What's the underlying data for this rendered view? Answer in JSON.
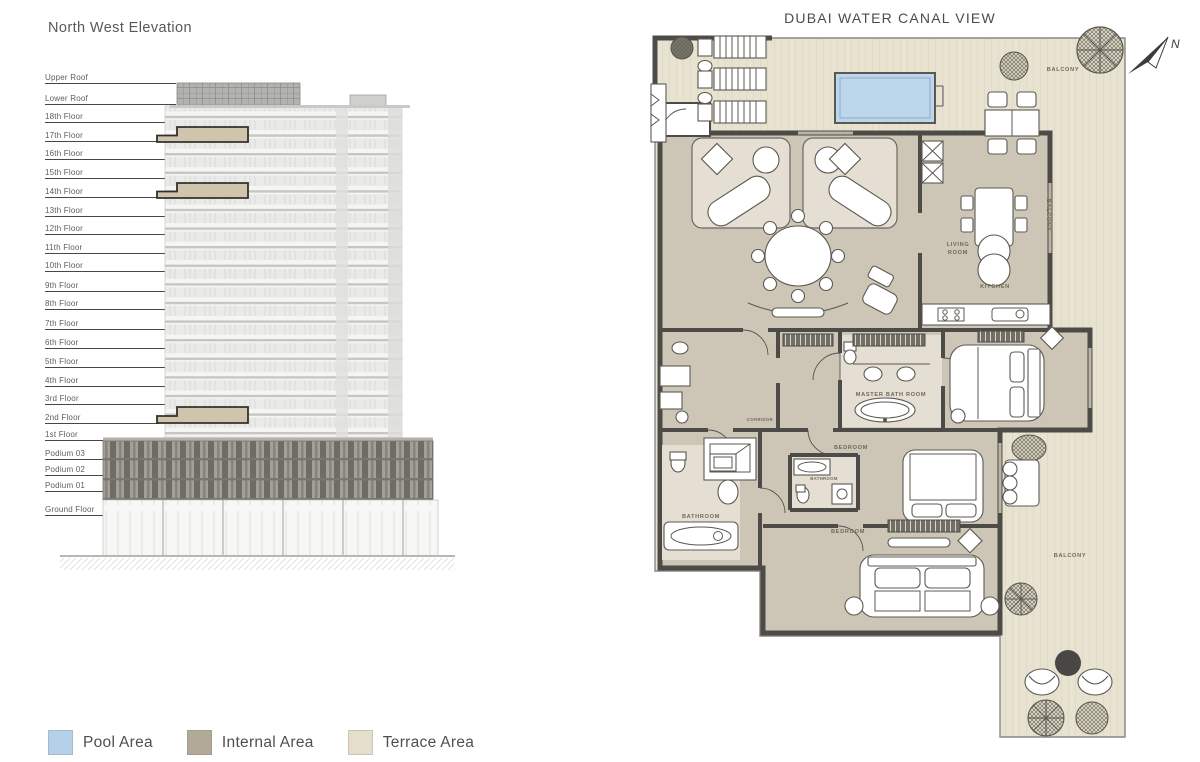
{
  "elevation": {
    "title": "North West Elevation",
    "floors": [
      "Upper Roof",
      "Lower Roof",
      "18th Floor",
      "17th Floor",
      "16th Floor",
      "15th Floor",
      "14th Floor",
      "13th Floor",
      "12th Floor",
      "11th Floor",
      "10th Floor",
      "9th Floor",
      "8th Floor",
      "7th Floor",
      "6th Floor",
      "5th Floor",
      "4th Floor",
      "3rd Floor",
      "2nd Floor",
      "1st Floor",
      "Podium 03",
      "Podium 02",
      "Podium 01",
      "Ground Floor"
    ],
    "highlight_color": "#cfc5ac"
  },
  "legend": {
    "items": [
      {
        "label": "Pool Area",
        "color": "#b5d0e9"
      },
      {
        "label": "Internal Area",
        "color": "#b2aa97"
      },
      {
        "label": "Terrace Area",
        "color": "#e4decb"
      }
    ]
  },
  "plan": {
    "title": "DUBAI WATER CANAL VIEW",
    "labels": {
      "living1": "LIVING",
      "living2": "ROOM",
      "kitchen": "KITCHEN",
      "master_bath": "MASTER BATH ROOM",
      "bedroom_mid": "BEDROOM",
      "bathroom_mid": "BATHROOM",
      "bathroom_left": "BATHROOM",
      "bedroom_bottom": "BEDROOM",
      "corridor": "CORRIDOR",
      "balcony_top": "BALCONY",
      "balcony_side": "BALCONY",
      "balcony_bottom": "BALCONY",
      "north": "N"
    },
    "colors": {
      "pool": "#bcd6ec",
      "internal": "#cdc6b6",
      "terrace": "#e8e3d1",
      "wall": "#4d4b47"
    }
  }
}
